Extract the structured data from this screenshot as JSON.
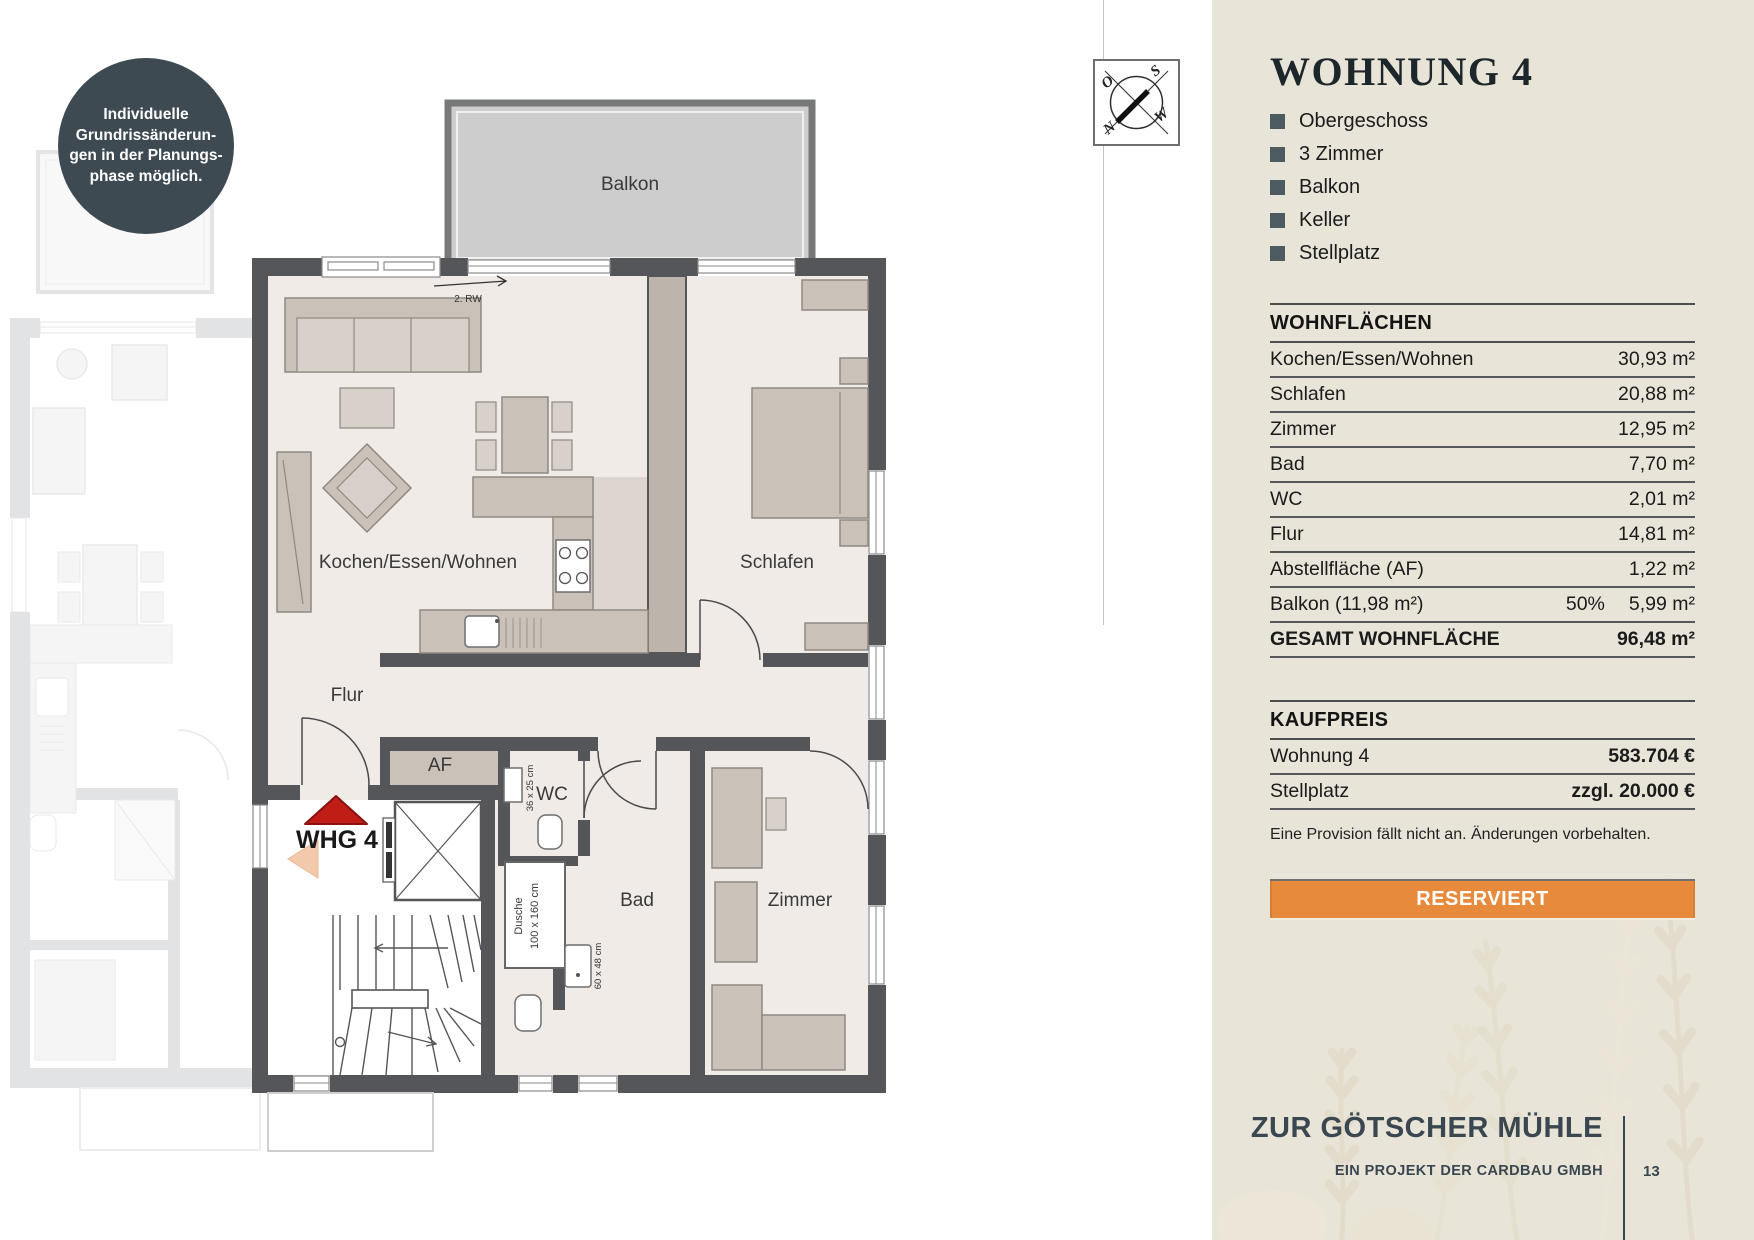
{
  "badge": {
    "lines": [
      "Individuelle",
      "Grundrissänderun-",
      "gen in der Planungs-",
      "phase möglich."
    ]
  },
  "compass": {
    "o": "O",
    "s": "S",
    "w": "W",
    "n": "N"
  },
  "plan": {
    "labels": {
      "balkon": "Balkon",
      "rw": "2. RW",
      "kochen": "Kochen/Essen/Wohnen",
      "schlafen": "Schlafen",
      "flur": "Flur",
      "af": "AF",
      "wc": "WC",
      "bad": "Bad",
      "zimmer": "Zimmer",
      "whg": "WHG 4",
      "dusche1": "Dusche",
      "dusche2": "100 x 160 cm",
      "wc_sink": "36 x 25 cm",
      "bad_sink": "60 x 48 cm"
    }
  },
  "panel": {
    "title": "WOHNUNG 4",
    "features": [
      "Obergeschoss",
      "3 Zimmer",
      "Balkon",
      "Keller",
      "Stellplatz"
    ],
    "areas": {
      "heading": "WOHNFLÄCHEN",
      "rows": [
        {
          "label": "Kochen/Essen/Wohnen",
          "value": "30,93 m²"
        },
        {
          "label": "Schlafen",
          "value": "20,88 m²"
        },
        {
          "label": "Zimmer",
          "value": "12,95 m²"
        },
        {
          "label": "Bad",
          "value": "7,70 m²"
        },
        {
          "label": "WC",
          "value": "2,01 m²"
        },
        {
          "label": "Flur",
          "value": "14,81 m²"
        },
        {
          "label": "Abstellfläche (AF)",
          "value": "1,22 m²"
        }
      ],
      "balkon": {
        "label": "Balkon (11,98 m²)",
        "pct": "50%",
        "value": "5,99 m²"
      },
      "total": {
        "label": "GESAMT WOHNFLÄCHE",
        "value": "96,48 m²"
      }
    },
    "price": {
      "heading": "KAUFPREIS",
      "rows": [
        {
          "label": "Wohnung 4",
          "value": "583.704 €"
        },
        {
          "label": "Stellplatz",
          "value": "zzgl. 20.000 €"
        }
      ]
    },
    "note": "Eine Provision fällt nicht an. Änderungen vorbehalten.",
    "status": "RESERVIERT",
    "footer": {
      "project": "ZUR GÖTSCHER MÜHLE",
      "subtitle": "EIN PROJEKT DER CARDBAU GMBH",
      "page": "13"
    }
  }
}
